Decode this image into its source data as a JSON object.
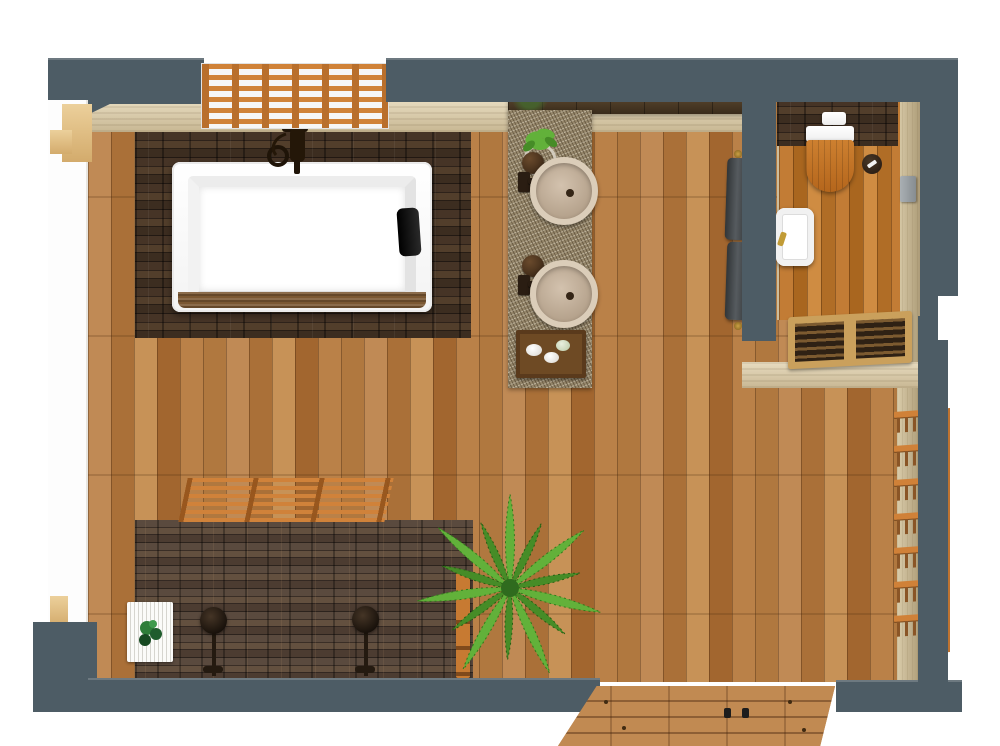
{
  "scene": {
    "type": "3d-floor-plan-render",
    "room": "bathroom",
    "view": "top-down",
    "areas": [
      "main-bathroom",
      "toilet-room",
      "shower-zone",
      "tub-zone",
      "vanity-zone",
      "entry"
    ]
  },
  "palette": {
    "wall_slate": "#4d5c65",
    "interior_beige": "#d8c9a9",
    "beige_dark": "#ab9a77",
    "trim_tan": "#e3c18a",
    "floor_wood": "#b47a42",
    "floor_wood_light": "#c79257",
    "floor_wood_dark": "#a2662f",
    "toilet_floor_wood": "#b5732c",
    "stone_dark": "#33271d",
    "stone_shower": "#473931",
    "granite": "#95866a",
    "pergola_orange": "#c87c34",
    "fixture_white": "#ffffff",
    "sink_beige": "#c3b09c",
    "faucet_bronze": "#2a1d12",
    "towel_gray": "#42474a",
    "toilet_seat_wood": "#c0701f",
    "brass": "#b68d2e",
    "gold": "#c19b36",
    "palm_green": "#62b13a",
    "palm_green_dark": "#468c27",
    "mat_white": "#f4f4f0",
    "exterior": "#ffffff"
  },
  "inventory": {
    "bathtub": 1,
    "tub_faucet": 1,
    "tub_headrest_pillow": 1,
    "vanity_vessel_sinks": 2,
    "vanity_faucets": 2,
    "soap_dispensers": 2,
    "vanity_plant": 1,
    "amenity_tray": 1,
    "wall_mirror": 1,
    "toilet": 1,
    "flush_plate": 1,
    "toilet_paper_holder": 1,
    "hand_basin": 1,
    "wall_accessory": 1,
    "hanging_towels": 2,
    "towel_hooks": 2,
    "shower_heads": 2,
    "shower_bath_mat": 1,
    "mat_plant": 1,
    "palm_plant": 1,
    "wood_post": 1,
    "ladder_rack_shelves": 7,
    "pergola_screens": 2,
    "window_lattice": 1,
    "duckboard_step": 1,
    "entry_deck": 1
  }
}
